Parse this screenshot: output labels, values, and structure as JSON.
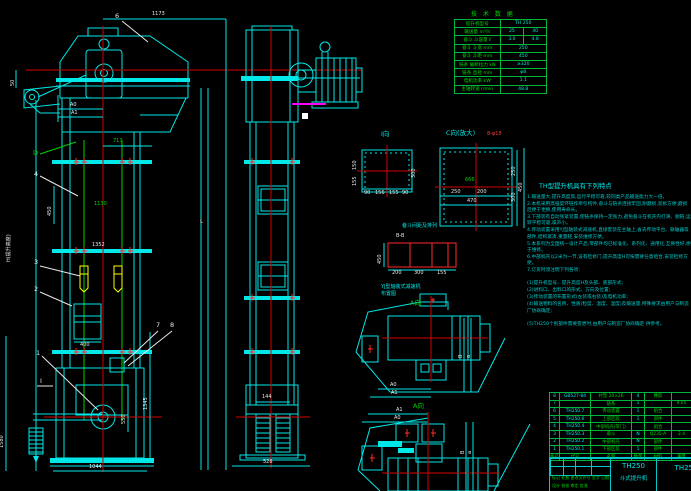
{
  "tech_table": {
    "title": "技 术 数 据",
    "rows": [
      [
        "提升机型号",
        "TH 250",
        ""
      ],
      [
        "输送量 m³/h",
        "25",
        "40"
      ],
      [
        "畚斗 斗容量 ℓ",
        "3.0",
        "4.8"
      ],
      [
        "畚斗 斗宽 mm",
        "250",
        ""
      ],
      [
        "畚斗 斗距 mm",
        "450",
        ""
      ],
      [
        "链条 破断拉力 kN",
        "≥320",
        ""
      ],
      [
        "链条 直径 mm",
        "φ8",
        ""
      ],
      [
        "电机功率 kW",
        "1.1",
        ""
      ],
      [
        "主轴转速 r/min",
        "48.8",
        ""
      ]
    ]
  },
  "features": {
    "title": "TH型提升机具有下列特点",
    "lines": [
      "1.输送量大,提升高度高,运行平稳可靠,较同类产品输送能力大一倍。",
      "2.本机采用高强度环链作牵引构件,畚斗与链条连接牢固,耐磨损,装拆方便,磨损后便于更换,使用寿命长。",
      "3.下部装有自动张紧装置,使链条保持一定张力,避免畚斗在机壳内打滑、脱链,运转平稳可靠,噪声小。",
      "4.传动装置采用YJ型轴装式减速机,直接套装在主轴上,省去传动平台、联轴器等部件,结构紧凑,重量轻,安装维修方便。",
      "5.本系列为全国统一设计产品,零部件均已标准化、系列化、通用化,互换性好,便于维修。",
      "6.中部机壳以2米为一节,设有检修门,提升高度H可按需要任意组合,安装检修方便。",
      "7.订货时须注明下列各项:",
      "(1)提升机型号、提升高度H及头部、底部形式;",
      "(2)进料口、出料口的形式、方向及位置;",
      "(3)传动装置的布置形式(左装或右装)及电机功率;",
      "(4)输送物料的名称、性质(粒度、温度、湿度)及输送量,特殊要求由用户与制造厂协商确定;",
      "(5)TH250个别部件需要变更时,由用户与制造厂协商确定 供参考。"
    ]
  },
  "bom": {
    "headers": [
      "件号",
      "代号",
      "名称",
      "数量",
      "材料",
      "重量"
    ],
    "rows": [
      [
        "8",
        "GB527-84",
        "衬垫 20×26",
        "4",
        "橡胶",
        ""
      ],
      [
        "7",
        "",
        "链条",
        "1",
        "",
        "9.05"
      ],
      [
        "6",
        "TH250.7",
        "传动装置",
        "1",
        "组合",
        ""
      ],
      [
        "5",
        "TH250.6",
        "上部区段",
        "1",
        "部件",
        ""
      ],
      [
        "4",
        "TH250.4",
        "中部机壳(带门)",
        "",
        "组合",
        ""
      ],
      [
        "3",
        "TH250.3",
        "畚斗",
        "N",
        "Q235-A",
        "2.4"
      ],
      [
        "2",
        "TH250.2",
        "中部机壳",
        "N",
        "部件",
        ""
      ],
      [
        "1",
        "TH250.1",
        "下部区段",
        "1",
        "部件",
        ""
      ]
    ]
  },
  "title_block": {
    "model": "TH250",
    "product": "斗式提升机",
    "drawing_no": "TH250",
    "sig1": "标记 处数 更改文件号 签字 日期",
    "sig2": "设计  校核  审定  批准"
  },
  "left_view": {
    "labels": {
      "p1": "1",
      "p2": "2",
      "p3": "3",
      "p4": "4",
      "p6": "6",
      "p7": "7",
      "p8": "8",
      "d": "D",
      "l": "L",
      "sec_i": "I",
      "dim1173": "1173",
      "dim50": "50",
      "a0": "A0",
      "a1": "A1",
      "dim713": "713",
      "dim450": "450",
      "dim1130": "1130",
      "dim1352": "1352",
      "dimH": "H(提升高度)",
      "dim400": "400",
      "dim550": "550",
      "dim1345": "1345",
      "dim1580": "1580",
      "dim1044": "1044"
    }
  },
  "middle_view": {
    "labels": {
      "dim144": "144",
      "dim528": "528"
    }
  },
  "details": {
    "i_view": {
      "label": "I向",
      "b1": "90",
      "b2": "156",
      "b3": "155",
      "b4": "90",
      "l1": "150",
      "l2": "155",
      "r1": "300"
    },
    "c_view": {
      "label": "C向(放大)",
      "holes": "8-φ18",
      "inner": "666",
      "b1": "250",
      "b2": "200",
      "b3": "470",
      "r1": "250",
      "r2": "300",
      "r3": "450"
    },
    "bucket": {
      "title": "畚斗间距及排列",
      "section": "B-B",
      "left": "450",
      "b1": "200",
      "b2": "300",
      "b3": "155"
    },
    "yj": {
      "line1": "YJ型轴装式减速机",
      "line2": "布置图"
    },
    "a_top": {
      "label": "A向",
      "a0": "A0",
      "a1": "A1",
      "r1": "B",
      "r2": "a"
    },
    "a_bottom": {
      "label": "A向",
      "a0": "A0",
      "a1": "A1",
      "r1": "B",
      "r2": "a"
    }
  }
}
